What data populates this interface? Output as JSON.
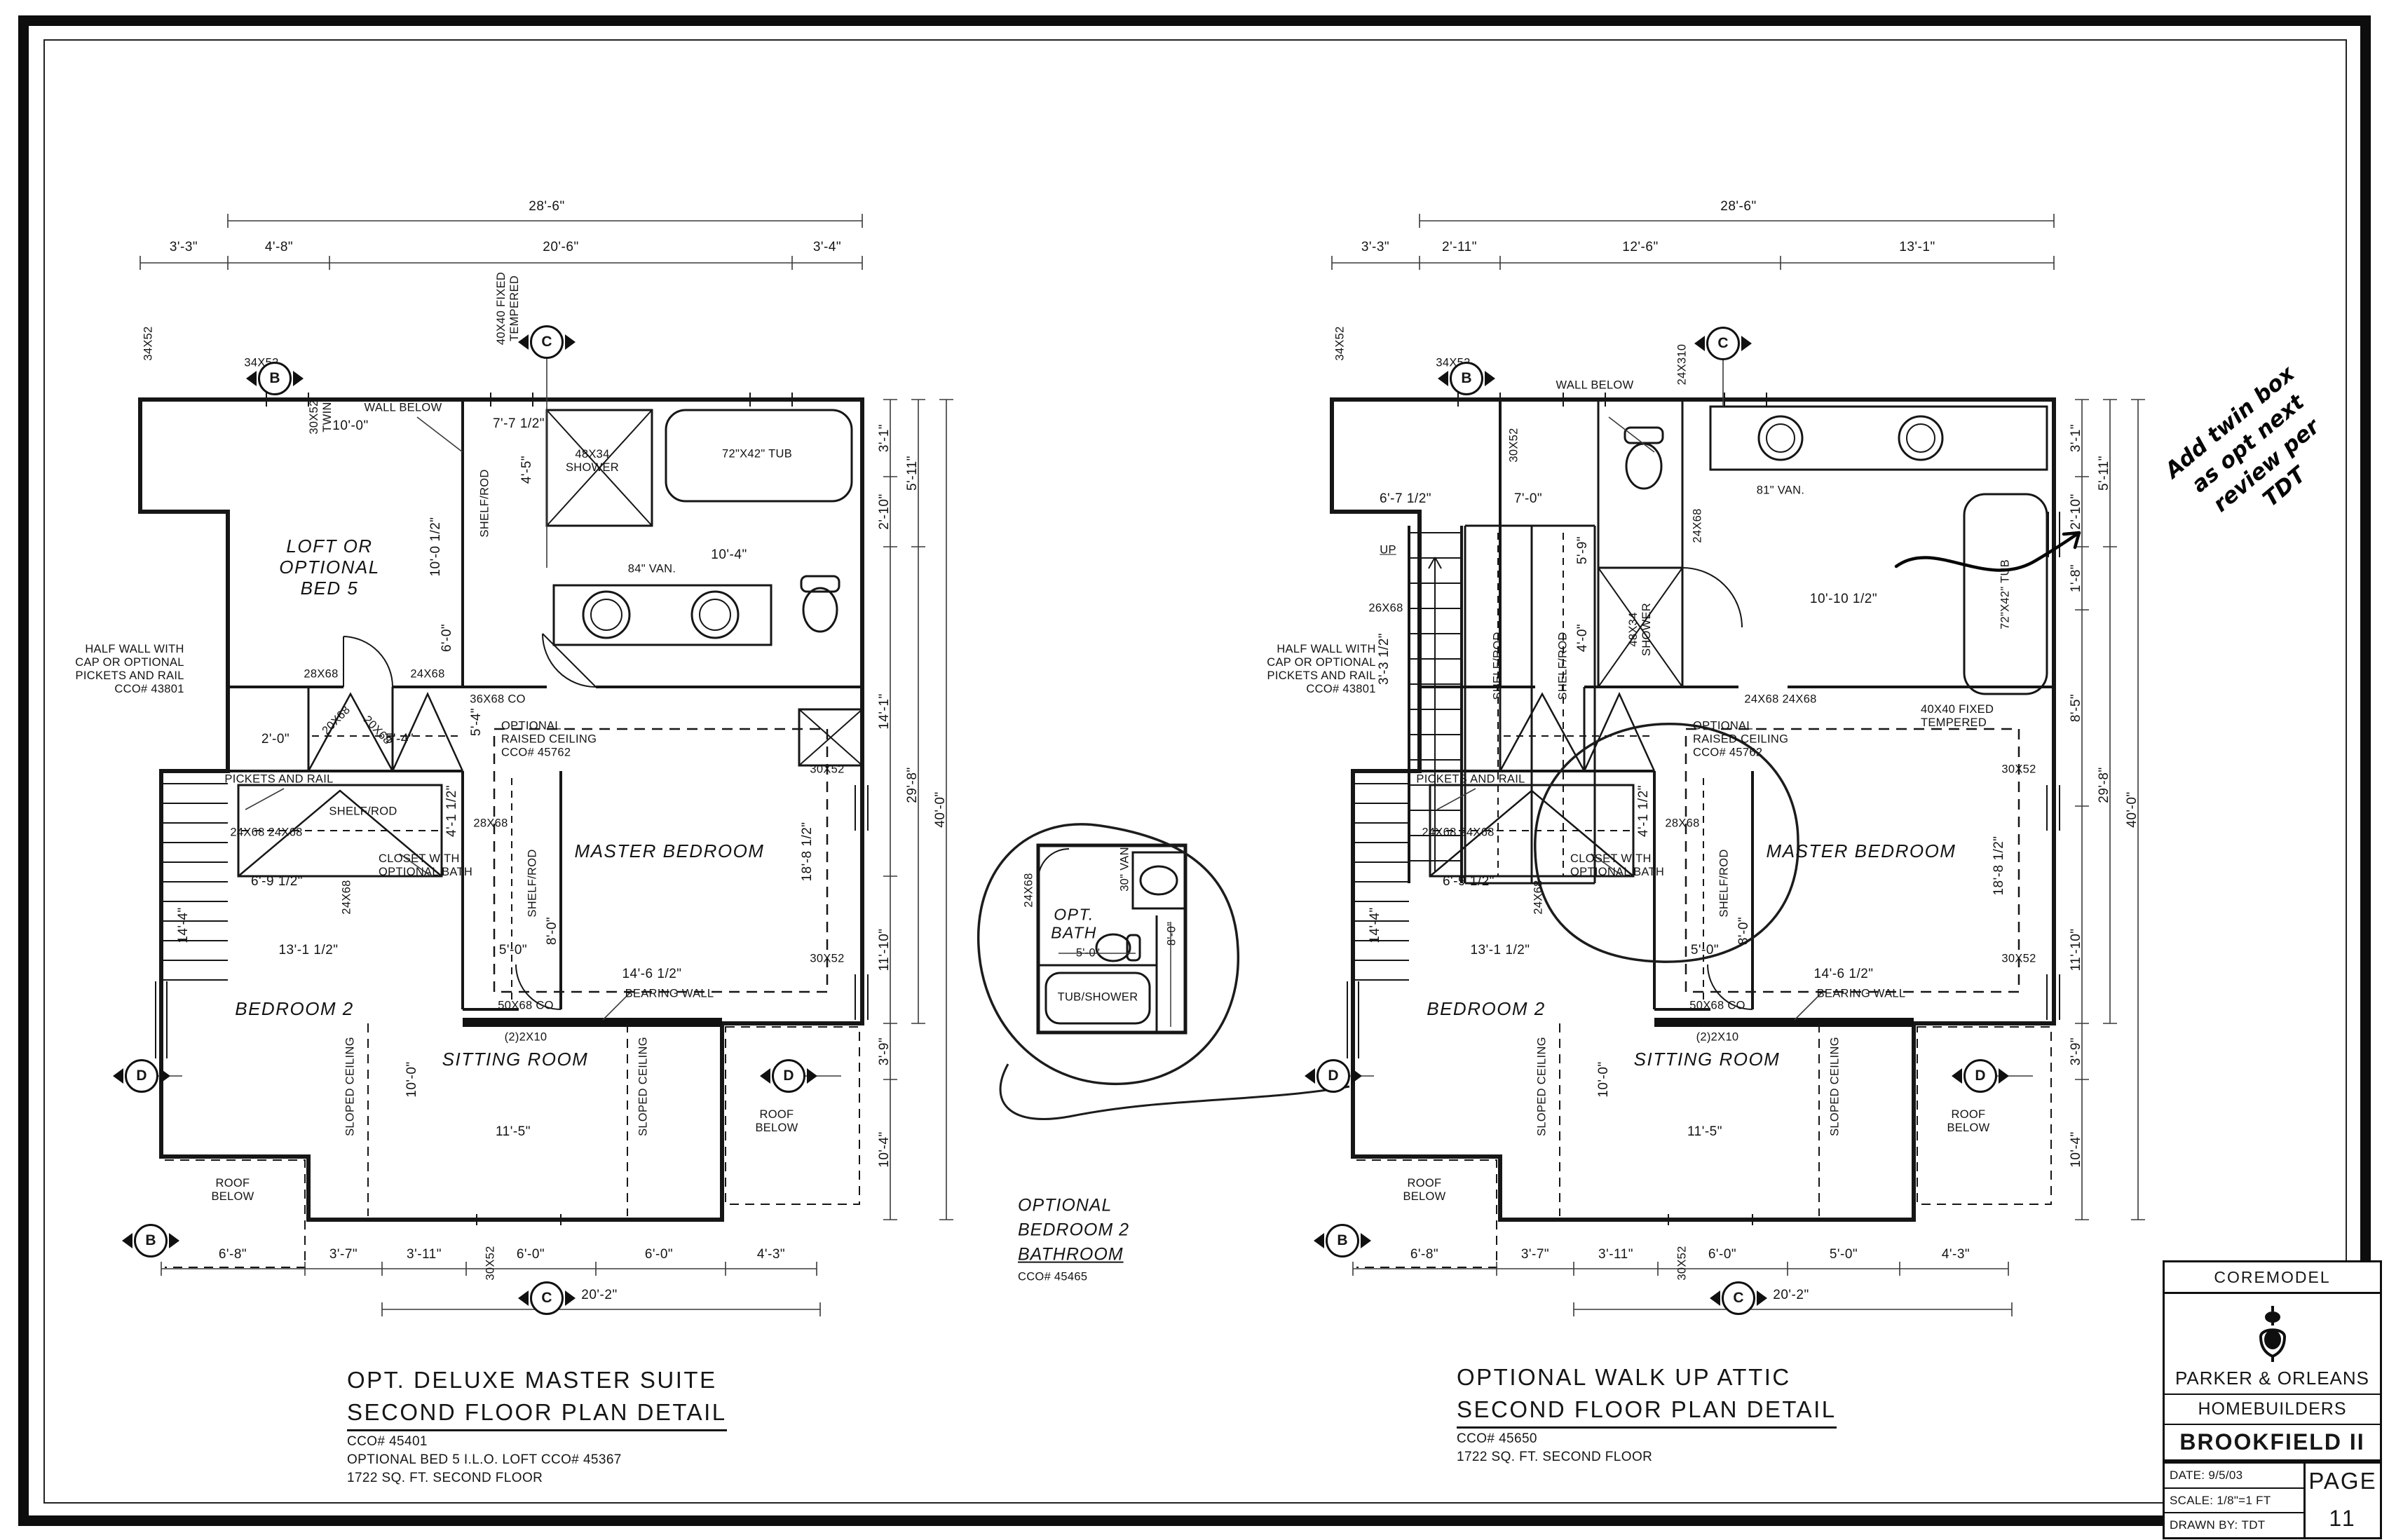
{
  "lp": {
    "title": "OPT. DELUXE MASTER SUITE",
    "sub": "SECOND FLOOR PLAN DETAIL",
    "n1": "CCO# 45401",
    "n2": "OPTIONAL BED 5 I.L.O. LOFT CCO# 45367",
    "n3": "1722 SQ. FT. SECOND FLOOR",
    "room_loft": "LOFT OR\nOPTIONAL\nBED 5",
    "room_master": "MASTER BEDROOM",
    "room_bed2": "BEDROOM 2",
    "room_sit": "SITTING ROOM",
    "half_wall": "HALF WALL WITH\nCAP OR OPTIONAL\nPICKETS AND RAIL\nCCO# 43801",
    "pickets": "PICKETS AND RAIL",
    "closet_bath": "CLOSET WITH\nOPTIONAL BATH",
    "raised": "OPTIONAL\nRAISED CEILING\nCCO# 45762",
    "bearing": "BEARING WALL",
    "wall_below": "WALL BELOW",
    "sloped": "SLOPED CEILING",
    "roof": "ROOF\nBELOW",
    "shelf": "SHELF/ROD",
    "shower": "48X34\nSHOWER",
    "tub": "72\"X42\" TUB",
    "van": "84\" VAN.",
    "co1": "36X68 CO",
    "co2": "50X68 CO",
    "joist": "(2)2X10",
    "fixed": "40X40 FIXED\nTEMPERED",
    "w_34x52": "34X52",
    "w_30x52_twin": "30X52\nTWIN",
    "w_30x52": "30X52",
    "d_28x68": "28X68",
    "d_24x68": "24X68",
    "d_24x68_pair": "24X68 24X68",
    "d_20x68": "20X68",
    "top": "28'-6\"",
    "t1": "3'-3\"",
    "t2": "4'-8\"",
    "t3": "20'-6\"",
    "t4": "3'-4\"",
    "r1": "3'-1\"",
    "r2": "2'-10\"",
    "r3": "5'-11\"",
    "r4": "14'-1\"",
    "r5": "29'-8\"",
    "r6": "40'-0\"",
    "r7": "11'-10\"",
    "r8": "3'-9\"",
    "r9": "10'-4\"",
    "b1": "6'-8\"",
    "b2": "3'-7\"",
    "b3": "3'-11\"",
    "b4": "6'-0\"",
    "b5": "6'-0\"",
    "b6": "4'-3\"",
    "b7": "20'-2\"",
    "i1": "10'-0\"",
    "i2": "10'-0 1/2\"",
    "i3": "7'-7 1/2\"",
    "i4": "4'-5\"",
    "i5": "10'-4\"",
    "i6": "5'-4\"",
    "i7": "5'-4\"",
    "i8": "2'-0\"",
    "i9": "6'-0\"",
    "i10": "18'-8 1/2\"",
    "i11": "14'-6 1/2\"",
    "i12": "5'-0\"",
    "i13": "8'-0\"",
    "i14": "6'-9 1/2\"",
    "i15": "13'-1 1/2\"",
    "i16": "14'-4\"",
    "i17": "4'-1 1/2\"",
    "i18": "11'-5\"",
    "i19": "10'-0\"",
    "mB": "B",
    "mC": "C",
    "mD": "D"
  },
  "rp": {
    "title": "OPTIONAL WALK UP ATTIC",
    "sub": "SECOND FLOOR PLAN DETAIL",
    "n1": "CCO# 45650",
    "n3": "1722 SQ. FT. SECOND FLOOR",
    "room_master": "MASTER BEDROOM",
    "room_bed2": "BEDROOM 2",
    "room_sit": "SITTING ROOM",
    "up": "UP",
    "half_wall": "HALF WALL WITH\nCAP OR OPTIONAL\nPICKETS AND RAIL\nCCO# 43801",
    "pickets": "PICKETS AND RAIL",
    "closet_bath": "CLOSET WITH\nOPTIONAL BATH",
    "raised": "OPTIONAL\nRAISED CEILING\nCCO# 45762",
    "bearing": "BEARING WALL",
    "wall_below": "WALL BELOW",
    "sloped": "SLOPED CEILING",
    "roof": "ROOF\nBELOW",
    "shelf": "SHELF/ROD",
    "shower": "48X34\nSHOWER",
    "tub": "72\"X42\" TUB",
    "van": "81\" VAN.",
    "co2": "50X68 CO",
    "joist": "(2)2X10",
    "fixed": "40X40 FIXED\nTEMPERED",
    "w_34x52": "34X52",
    "w_30x52": "30X52",
    "w_24x310": "24X310",
    "d_28x68": "28X68",
    "d_26x68": "26X68",
    "d_24x68": "24X68",
    "d_24x68_pair": "24X68 24X68",
    "top": "28'-6\"",
    "t1": "3'-3\"",
    "t2": "2'-11\"",
    "t3": "12'-6\"",
    "t4": "13'-1\"",
    "r1": "3'-1\"",
    "r2": "2'-10\"",
    "r3": "5'-11\"",
    "rA": "1'-8\"",
    "rB": "8'-5\"",
    "r5": "29'-8\"",
    "r6": "40'-0\"",
    "r7": "11'-10\"",
    "r8": "3'-9\"",
    "r9": "10'-4\"",
    "b1": "6'-8\"",
    "b2": "3'-7\"",
    "b3": "3'-11\"",
    "b4": "6'-0\"",
    "b5": "5'-0\"",
    "b6": "4'-3\"",
    "b7": "20'-2\"",
    "i_67": "6'-7 1/2\"",
    "i_70": "7'-0\"",
    "i_59": "5'-9\"",
    "i_40": "4'-0\"",
    "i_33": "3'-3 1/2\"",
    "i_1010": "10'-10 1/2\"",
    "i10": "18'-8 1/2\"",
    "i11": "14'-6 1/2\"",
    "i12": "5'-0\"",
    "i13": "8'-0\"",
    "i14": "6'-9 1/2\"",
    "i15": "13'-1 1/2\"",
    "i16": "14'-4\"",
    "i17": "4'-1 1/2\"",
    "i18": "11'-5\"",
    "i19": "10'-0\"",
    "mB": "B",
    "mC": "C",
    "mD": "D"
  },
  "detail": {
    "d_24x68": "24X68",
    "van": "30\" VAN",
    "room": "OPT.\nBATH",
    "w": "5'-0\"",
    "h": "8'-0\"",
    "tub": "TUB/SHOWER",
    "c1": "OPTIONAL",
    "c2": "BEDROOM 2",
    "c3": "BATHROOM",
    "c4": "CCO# 45465"
  },
  "note": {
    "l1": "Add twin box",
    "l2": "as opt next",
    "l3": "review per",
    "l4": "TDT"
  },
  "tb": {
    "model": "COREMODEL",
    "co1": "PARKER & ORLEANS",
    "co2": "HOMEBUILDERS",
    "plan": "BROOKFIELD II",
    "date_l": "DATE:",
    "date": "9/5/03",
    "scale_l": "SCALE:",
    "scale": "1/8\"=1 FT",
    "drawn_l": "DRAWN BY:",
    "drawn": "TDT",
    "page_l": "PAGE",
    "page": "11"
  }
}
